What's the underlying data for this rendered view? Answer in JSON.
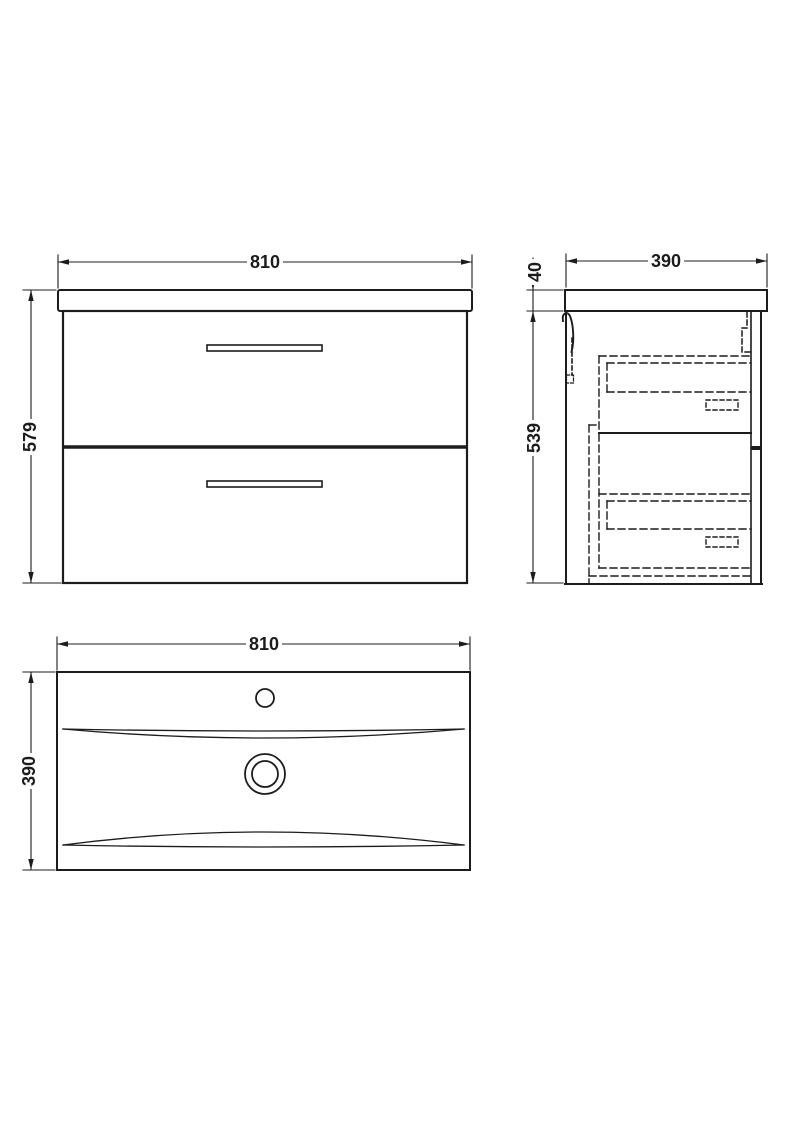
{
  "views": {
    "front": {
      "width_label": "810",
      "height_label": "579"
    },
    "side": {
      "depth_label": "390",
      "worktop_thickness_label": "40",
      "height_label": "539"
    },
    "plan": {
      "width_label": "810",
      "depth_label": "390"
    }
  },
  "colors": {
    "line": "#1c1c1c",
    "background": "#ffffff"
  }
}
